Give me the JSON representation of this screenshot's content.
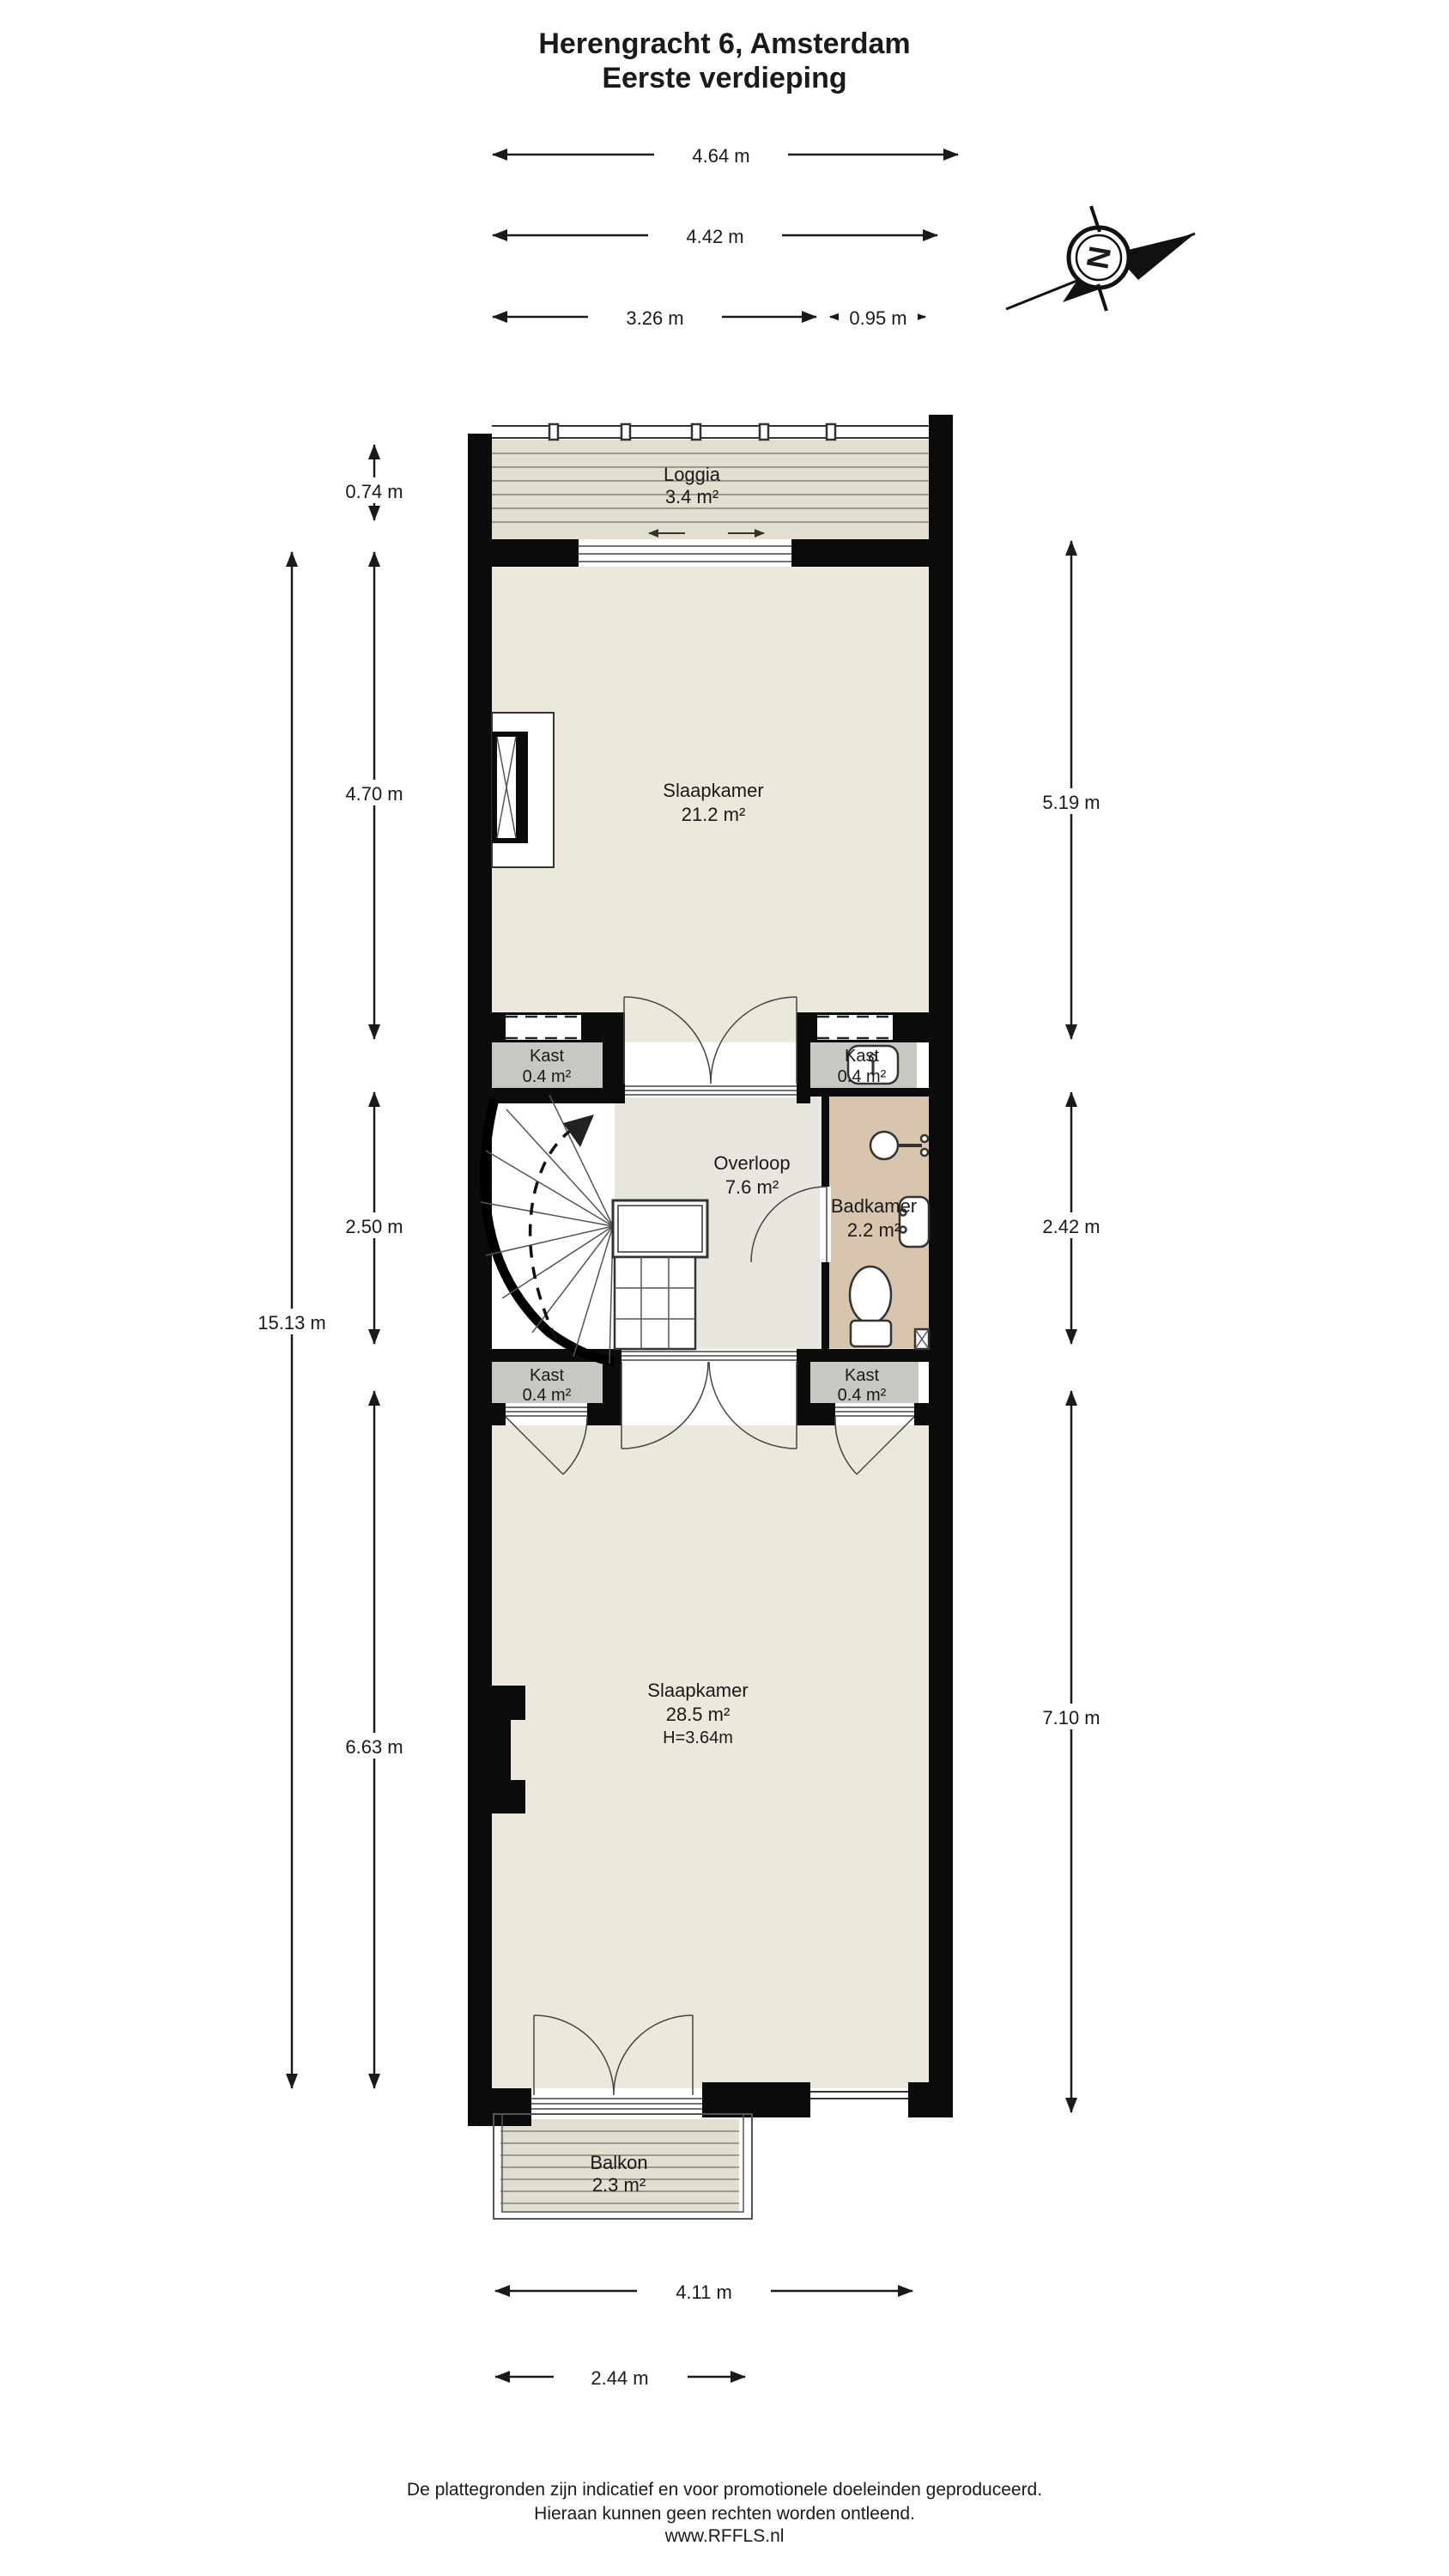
{
  "title": {
    "line1": "Herengracht 6, Amsterdam",
    "line2": "Eerste verdieping"
  },
  "compass": {
    "north_label": "N"
  },
  "rooms": {
    "loggia": {
      "name": "Loggia",
      "area": "3.4 m²"
    },
    "slaapkamer_boven": {
      "name": "Slaapkamer",
      "area": "21.2 m²"
    },
    "kast_links_boven": {
      "name": "Kast",
      "area": "0.4 m²"
    },
    "kast_rechts_boven": {
      "name": "Kast",
      "area": "0.4 m²"
    },
    "overloop": {
      "name": "Overloop",
      "area": "7.6 m²"
    },
    "badkamer": {
      "name": "Badkamer",
      "area": "2.2 m²"
    },
    "kast_links_onder": {
      "name": "Kast",
      "area": "0.4 m²"
    },
    "kast_rechts_onder": {
      "name": "Kast",
      "area": "0.4 m²"
    },
    "slaapkamer_onder": {
      "name": "Slaapkamer",
      "area": "28.5 m²",
      "ceiling_height": "H=3.64m"
    },
    "balkon": {
      "name": "Balkon",
      "area": "2.3 m²"
    }
  },
  "dimensions": {
    "top": [
      {
        "label": "4.64 m"
      },
      {
        "label": "4.42 m"
      },
      {
        "label": "3.26 m"
      },
      {
        "label": "0.95 m"
      }
    ],
    "left": [
      {
        "label": "0.74 m"
      },
      {
        "label": "4.70 m"
      },
      {
        "label": "2.50 m"
      },
      {
        "label": "6.63 m"
      },
      {
        "label": "15.13 m"
      }
    ],
    "right": [
      {
        "label": "5.19 m"
      },
      {
        "label": "2.42 m"
      },
      {
        "label": "7.10 m"
      }
    ],
    "bottom": [
      {
        "label": "4.11 m"
      },
      {
        "label": "2.44 m"
      }
    ]
  },
  "footer": {
    "line1": "De plattegronden zijn indicatief en voor promotionele doeleinden geproduceerd.",
    "line2": "Hieraan kunnen geen rechten worden ontleend.",
    "line3": "www.RFFLS.nl"
  },
  "colors": {
    "wall": "#0b0b0b",
    "floor_cream": "#ece8db",
    "floor_grey": "#c8c8c3",
    "floor_overloop": "#e9e6e0",
    "floor_badkamer": "#d8c5ae",
    "deck": "#e2ded0",
    "deck_line": "#84827b",
    "ink": "#1a1a1a"
  }
}
